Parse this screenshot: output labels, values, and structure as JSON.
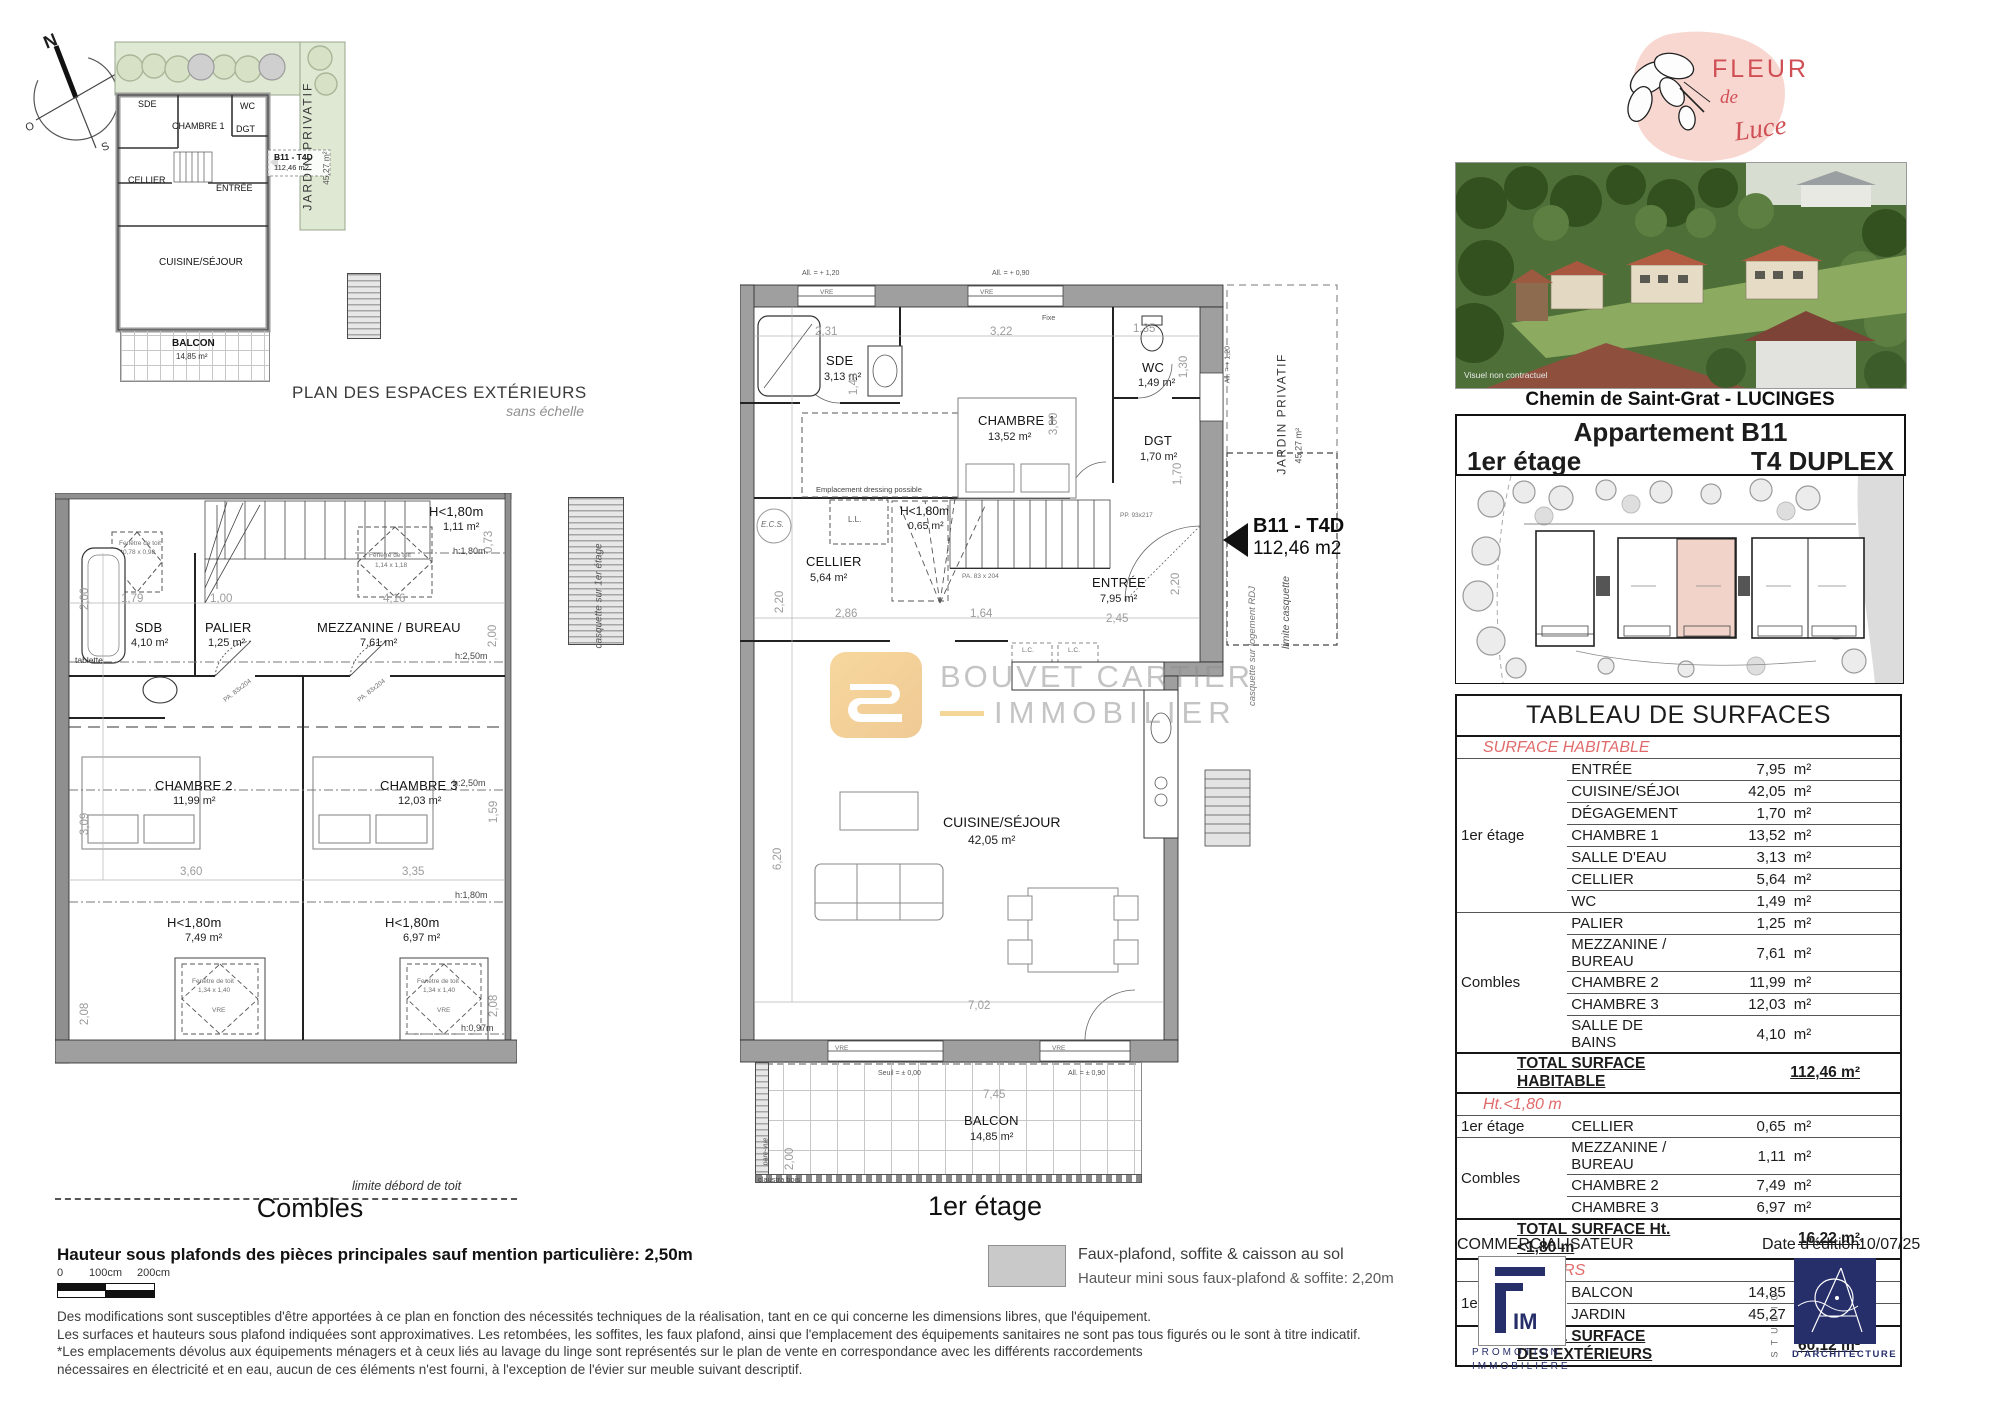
{
  "compass": {
    "n": "N",
    "e": "E",
    "s": "S",
    "o": "O"
  },
  "watermark": {
    "line1": "BOUVET CARTIER",
    "line2": "IMMOBILIER"
  },
  "colors": {
    "logo_pink": "#f6d3cc",
    "logo_red": "#cf4f55",
    "navy": "#272f6b",
    "watermark_orange": "#eaa73e",
    "section_red": "#e06a6a",
    "garden_green": "#dfe8d3",
    "unit_pink": "#f2d3ca"
  },
  "exterior_plan": {
    "title": "PLAN DES ESPACES EXTÉRIEURS",
    "subtitle": "sans échelle",
    "jardin_label": "JARDIN PRIVATIF",
    "jardin_area": "45,27 m²",
    "marker_label": "B11 - T4D",
    "marker_area": "112,46 m2",
    "rooms": {
      "sde": "SDE",
      "chambre1": "CHAMBRE 1",
      "wc": "WC",
      "dgt": "DGT",
      "cellier": "CELLIER",
      "entree": "ENTRÉE",
      "cuisine": "CUISINE/SÉJOUR",
      "balcon": "BALCON",
      "balcon_area": "14,85 m²"
    }
  },
  "combles": {
    "title": "Combles",
    "limite_toit": "limite débord de toit",
    "casquette": "casquette sur 1er étage",
    "rooms": {
      "sdb": "SDB",
      "sdb_area": "4,10 m²",
      "palier": "PALIER",
      "palier_area": "1,25 m²",
      "mezzanine": "MEZZANINE / BUREAU",
      "mezzanine_area": "7,61 m²",
      "chambre2": "CHAMBRE 2",
      "chambre2_area": "11,99 m²",
      "chambre3": "CHAMBRE 3",
      "chambre3_area": "12,03 m²",
      "h180_top": "H<1,80m",
      "h180_top_area": "1,11 m²",
      "h180_left": "H<1,80m",
      "h180_left_area": "7,49 m²",
      "h180_right": "H<1,80m",
      "h180_right_area": "6,97 m²"
    },
    "ann": {
      "tablette": "tablette",
      "fenetre": "Fenêtre de toit",
      "fen1_size": "0,78 x 0,98",
      "fen2_size": "1,14 x 1,18",
      "fen3_size": "1,34 x 1,40",
      "fen4_size": "1,34 x 1,40",
      "vre": "VRE",
      "h250": "h:2,50m",
      "h180": "h:1,80m",
      "h097": "h:0,97m",
      "door": "PA. 83x204"
    },
    "dims": {
      "d200l": "2,00",
      "d179": "1,79",
      "d100": "1,00",
      "d416": "4,16",
      "d073": "0,73",
      "d200r": "2,00",
      "d309": "3,09",
      "d159": "1,59",
      "d360": "3,60",
      "d335": "3,35",
      "d208l": "2,08",
      "d208r": "2,08"
    }
  },
  "first_floor": {
    "title": "1er étage",
    "marker_label": "B11 - T4D",
    "marker_area": "112,46 m2",
    "rooms": {
      "sde": "SDE",
      "sde_area": "3,13 m²",
      "chambre1": "CHAMBRE 1",
      "chambre1_area": "13,52 m²",
      "wc": "WC",
      "wc_area": "1,49 m²",
      "dgt": "DGT",
      "dgt_area": "1,70 m²",
      "cellier": "CELLIER",
      "cellier_area": "5,64 m²",
      "h180": "H<1,80m",
      "h180_area": "0,65 m²",
      "entree": "ENTRÉE",
      "entree_area": "7,95 m²",
      "cuisine": "CUISINE/SÉJOUR",
      "cuisine_area": "42,05 m²",
      "balcon": "BALCON",
      "balcon_area": "14,85 m²"
    },
    "ann": {
      "all120_top": "All. = + 1,20",
      "all090_top": "All. = + 0,90",
      "all120_right": "All. = + 1,20",
      "vre": "VRE",
      "fixe": "Fixe",
      "dressing": "Emplacement dressing possible",
      "ecs": "E.C.S.",
      "ll": "L.L.",
      "lc": "L.C.",
      "jardin": "JARDIN PRIVATIF",
      "jardin_area": "45,27 m²",
      "limite_casquette": "limite casquette",
      "casquette_rdj": "casquette sur logement RDJ",
      "seuil": "Seuil = ± 0,00",
      "all090_balcon": "All. = ± 0,90",
      "pare_vue": "pare-vue",
      "claustra": "claustra bois",
      "door_pp": "PP. 93x217",
      "door_pa": "PA. 83 x 204"
    },
    "dims": {
      "d231": "2,31",
      "d143": "1,43",
      "d322": "3,22",
      "d135": "1,35",
      "d130": "1,30",
      "d300": "3,00",
      "d170": "1,70",
      "d220a": "2,20",
      "d286": "2,86",
      "d164": "1,64",
      "d245": "2,45",
      "d220b": "2,20",
      "d620": "6,20",
      "d702": "7,02",
      "d745": "7,45",
      "d200": "2,00"
    }
  },
  "sidebar": {
    "logo": {
      "word1": "FLEUR",
      "word2": "de",
      "word3": "Luce"
    },
    "photo_caption": "Visuel non contractuel",
    "address": "Chemin de Saint-Grat - LUCINGES",
    "unit": {
      "name": "Appartement B11",
      "floor": "1er étage",
      "type": "T4 DUPLEX"
    },
    "table": {
      "title": "TABLEAU DE SURFACES",
      "unit": "m²",
      "sec_hab": "SURFACE HABITABLE",
      "sec_ht": "Ht.<1,80 m",
      "sec_ext": "EXTÉRIEURS",
      "floor_1er_a": "1er étage",
      "floor_combles_a": "Combles",
      "floor_1er_b": "1er étage",
      "floor_combles_b": "Combles",
      "floor_1er_c": "1er étage",
      "hab1": [
        {
          "room": "ENTRÉE",
          "area": "7,95"
        },
        {
          "room": "CUISINE/SÉJOUR",
          "area": "42,05"
        },
        {
          "room": "DÉGAGEMENT",
          "area": "1,70"
        },
        {
          "room": "CHAMBRE 1",
          "area": "13,52"
        },
        {
          "room": "SALLE D'EAU",
          "area": "3,13"
        },
        {
          "room": "CELLIER",
          "area": "5,64"
        },
        {
          "room": "WC",
          "area": "1,49"
        }
      ],
      "hab2": [
        {
          "room": "PALIER",
          "area": "1,25"
        },
        {
          "room": "MEZZANINE / BUREAU",
          "area": "7,61"
        },
        {
          "room": "CHAMBRE 2",
          "area": "11,99"
        },
        {
          "room": "CHAMBRE 3",
          "area": "12,03"
        },
        {
          "room": "SALLE DE BAINS",
          "area": "4,10"
        }
      ],
      "total_hab_label": "TOTAL SURFACE HABITABLE",
      "total_hab_value": "112,46 m²",
      "ht1": [
        {
          "room": "CELLIER",
          "area": "0,65"
        }
      ],
      "ht2": [
        {
          "room": "MEZZANINE / BUREAU",
          "area": "1,11"
        },
        {
          "room": "CHAMBRE 2",
          "area": "7,49"
        },
        {
          "room": "CHAMBRE 3",
          "area": "6,97"
        }
      ],
      "total_ht_label": "TOTAL SURFACE Ht. <1,80 m",
      "total_ht_value": "16,22 m²",
      "ext": [
        {
          "room": "BALCON",
          "area": "14,85"
        },
        {
          "room": "JARDIN",
          "area": "45,27"
        }
      ],
      "total_ext_label": "TOTAL SURFACE DES EXTÉRIEURS",
      "total_ext_value": "60,12 m²"
    },
    "commercialisateur": "COMMERCIALISATEUR",
    "date_label": "Date d'édition:",
    "date_value": "10/07/25",
    "fim": {
      "im": "IM",
      "line1": "PROMOTION",
      "line2": "IMMOBILIÈRE"
    },
    "studio": {
      "name": "STUDIO",
      "caption": "D'ARCHITECTURE"
    }
  },
  "footer": {
    "ceiling_note": "Hauteur sous plafonds des pièces principales sauf mention particulière: 2,50m",
    "scale": {
      "t0": "0",
      "t100": "100cm",
      "t200": "200cm"
    },
    "legend": {
      "line1": "Faux-plafond, soffite & caisson au sol",
      "line2": "Hauteur mini sous faux-plafond & soffite: 2,20m"
    },
    "disclaimer": [
      "Des modifications sont susceptibles d'être apportées à ce plan en fonction des nécessités techniques de la réalisation, tant en ce qui concerne les dimensions libres, que l'équipement.",
      "Les surfaces et hauteurs sous plafond indiquées sont approximatives. Les retombées, les soffites, les faux plafond, ainsi que l'emplacement des équipements sanitaires ne sont pas tous figurés ou le sont à titre indicatif.",
      "*Les emplacements dévolus aux équipements ménagers et à ceux liés au lavage du linge sont représentés sur le plan de vente en correspondance avec les différents raccordements",
      "nécessaires en électricité et en eau, aucun de ces éléments n'est fourni, à l'exception de l'évier sur meuble suivant descriptif."
    ]
  }
}
